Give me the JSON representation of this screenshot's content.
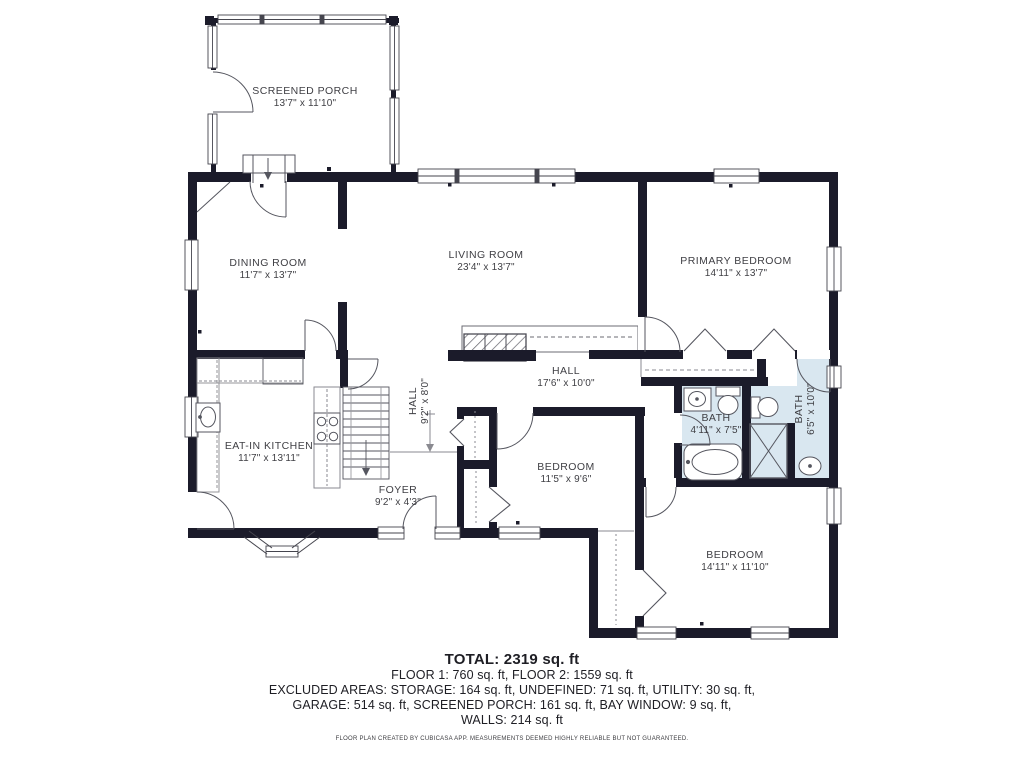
{
  "rooms": [
    {
      "name": "SCREENED PORCH",
      "dims": "13'7\" x 11'10\""
    },
    {
      "name": "DINING ROOM",
      "dims": "11'7\" x 13'7\""
    },
    {
      "name": "LIVING ROOM",
      "dims": "23'4\" x 13'7\""
    },
    {
      "name": "PRIMARY BEDROOM",
      "dims": "14'11\" x 13'7\""
    },
    {
      "name": "HALL",
      "dims": "17'6\" x 10'0\""
    },
    {
      "name": "HALL",
      "dims": "9'2\" x 8'0\""
    },
    {
      "name": "EAT-IN KITCHEN",
      "dims": "11'7\" x 13'11\""
    },
    {
      "name": "FOYER",
      "dims": "9'2\" x 4'3\""
    },
    {
      "name": "BEDROOM",
      "dims": "11'5\" x 9'6\""
    },
    {
      "name": "BATH",
      "dims": "4'11\" x 7'5\""
    },
    {
      "name": "BATH",
      "dims": "6'5\" x 10'0\""
    },
    {
      "name": "BEDROOM",
      "dims": "14'11\" x 11'10\""
    }
  ],
  "summary": {
    "total": "TOTAL: 2319 sq. ft",
    "floors": "FLOOR 1: 760 sq. ft, FLOOR 2: 1559 sq. ft",
    "excluded_line1": "EXCLUDED AREAS: STORAGE: 164 sq. ft, UNDEFINED: 71 sq. ft, UTILITY: 30 sq. ft,",
    "excluded_line2": "GARAGE: 514 sq. ft, SCREENED PORCH: 161 sq. ft, BAY WINDOW: 9 sq. ft,",
    "walls_line": "WALLS: 214 sq. ft",
    "disclaimer": "FLOOR PLAN CREATED BY CUBICASA APP. MEASUREMENTS DEEMED HIGHLY RELIABLE BUT NOT GUARANTEED."
  },
  "colors": {
    "wall": "#1b1b2a",
    "bath_floor": "#d9e7f0",
    "label_text": "#3f3f44",
    "line": "#55565f"
  }
}
